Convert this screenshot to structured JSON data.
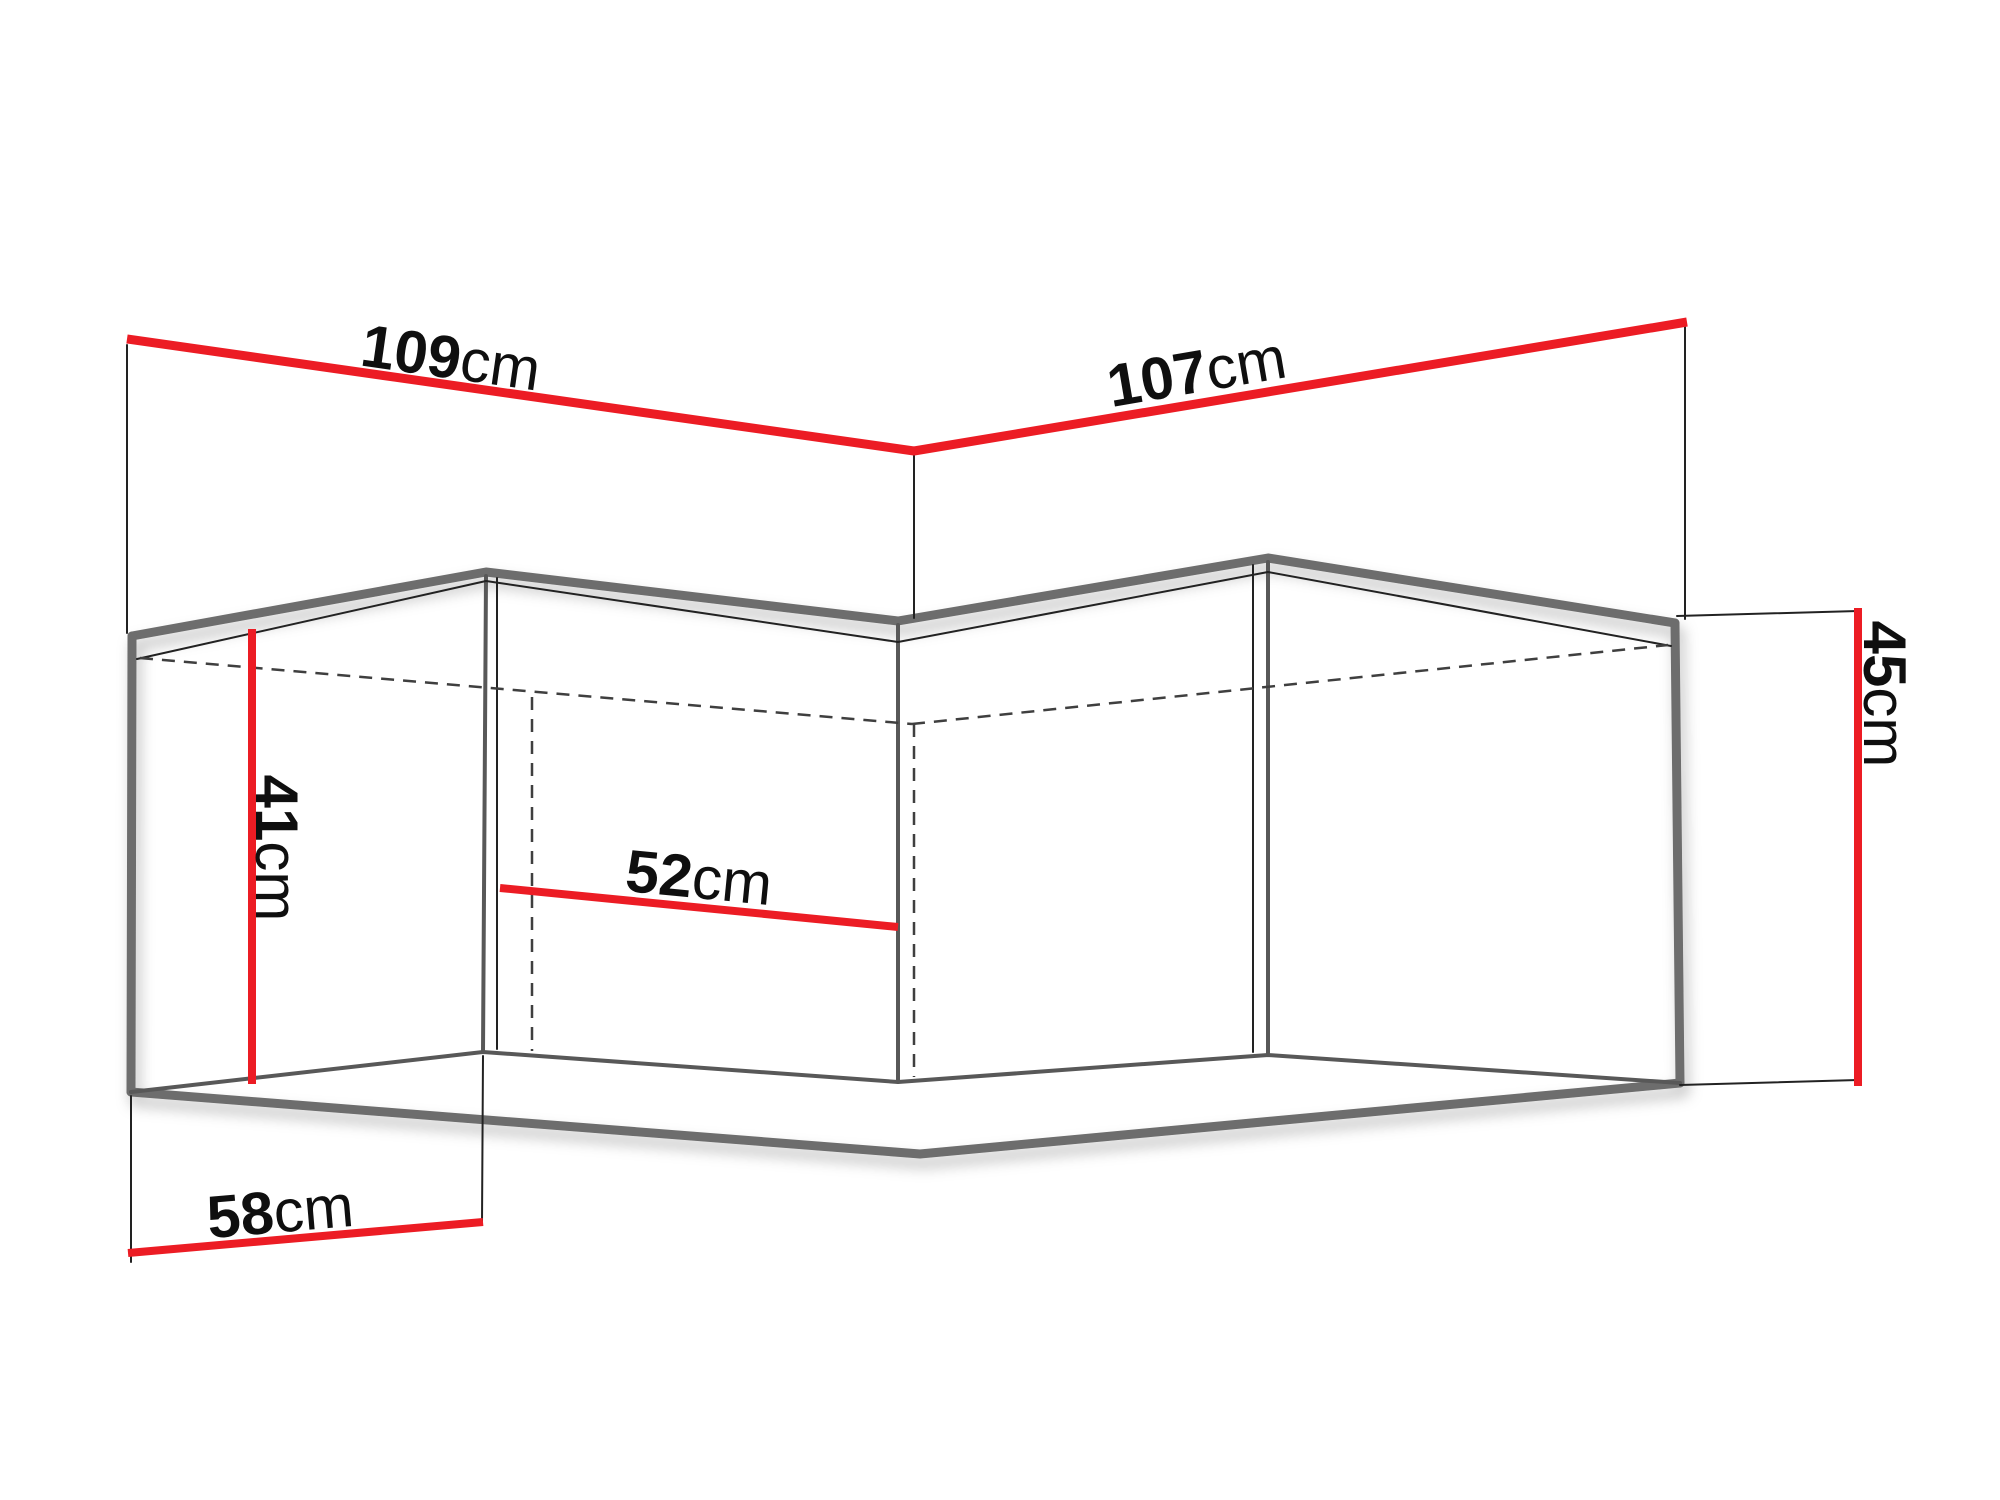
{
  "diagram": {
    "title": "corner-wall-cabinet-dimensions",
    "background": "#ffffff",
    "colors": {
      "dimension_line": "#ec1c24",
      "outline_thick": "#6d6d6d",
      "outline_medium": "#585858",
      "outline_thin": "#222222",
      "hidden_edge": "#3f3f3f",
      "label_text": "#0f0f0f"
    },
    "dimensions": [
      {
        "id": "top-width-left",
        "value": "109",
        "unit": "cm"
      },
      {
        "id": "top-width-right",
        "value": "107",
        "unit": "cm"
      },
      {
        "id": "front-height-left",
        "value": "41",
        "unit": "cm"
      },
      {
        "id": "inner-depth",
        "value": "52",
        "unit": "cm"
      },
      {
        "id": "side-depth-left",
        "value": "58",
        "unit": "cm"
      },
      {
        "id": "side-height-right",
        "value": "45",
        "unit": "cm"
      }
    ]
  }
}
